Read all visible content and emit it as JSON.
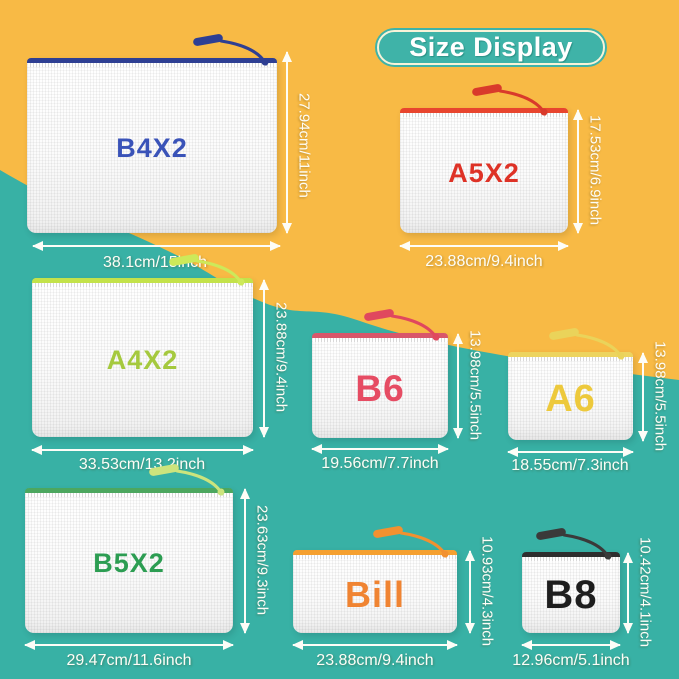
{
  "title": {
    "text": "Size Display"
  },
  "colors": {
    "background_yellow": "#F8BA45",
    "background_teal": "#38B1A5",
    "title_badge": "#3FB3A8",
    "title_badge_inner_border": "#F8F3D8",
    "title_text": "#FFFFFF",
    "arrow": "#FDFDF7",
    "dimension_text": "#FDFDF7"
  },
  "pouches": [
    {
      "name": "B4X2",
      "label": "B4X2",
      "label_color": "#3A53B8",
      "zipper_color": "#2E3F93",
      "pull_color": "#2E3F93",
      "height_label": "27.94cm/11inch",
      "width_label": "38.1cm/15inch"
    },
    {
      "name": "A5X2",
      "label": "A5X2",
      "label_color": "#DE3226",
      "zipper_color": "#E8452E",
      "pull_color": "#D93A2B",
      "height_label": "17.53cm/6.9inch",
      "width_label": "23.88cm/9.4inch"
    },
    {
      "name": "A4X2",
      "label": "A4X2",
      "label_color": "#A5C93E",
      "zipper_color": "#C3E24A",
      "pull_color": "#CDE95A",
      "height_label": "23.88cm/9.4inch",
      "width_label": "33.53cm/13.2inch"
    },
    {
      "name": "B6",
      "label": "B6",
      "label_color": "#E64C63",
      "zipper_color": "#D9566A",
      "pull_color": "#E0485E",
      "height_label": "13.98cm/5.5inch",
      "width_label": "19.56cm/7.7inch"
    },
    {
      "name": "A6",
      "label": "A6",
      "label_color": "#EDC93C",
      "zipper_color": "#EDD45F",
      "pull_color": "#EAD35A",
      "height_label": "13.98cm/5.5inch",
      "width_label": "18.55cm/7.3inch"
    },
    {
      "name": "B5X2",
      "label": "B5X2",
      "label_color": "#2C9D52",
      "zipper_color": "#4CA75F",
      "pull_color": "#CCE47D",
      "height_label": "23.63cm/9.3inch",
      "width_label": "29.47cm/11.6inch"
    },
    {
      "name": "Bill",
      "label": "Bill",
      "label_color": "#F08432",
      "zipper_color": "#F5A030",
      "pull_color": "#F29130",
      "height_label": "10.93cm/4.3inch",
      "width_label": "23.88cm/9.4inch"
    },
    {
      "name": "B8",
      "label": "B8",
      "label_color": "#1E1E1E",
      "zipper_color": "#2E2E2E",
      "pull_color": "#3A3A3A",
      "height_label": "10.42cm/4.1inch",
      "width_label": "12.96cm/5.1inch"
    }
  ]
}
